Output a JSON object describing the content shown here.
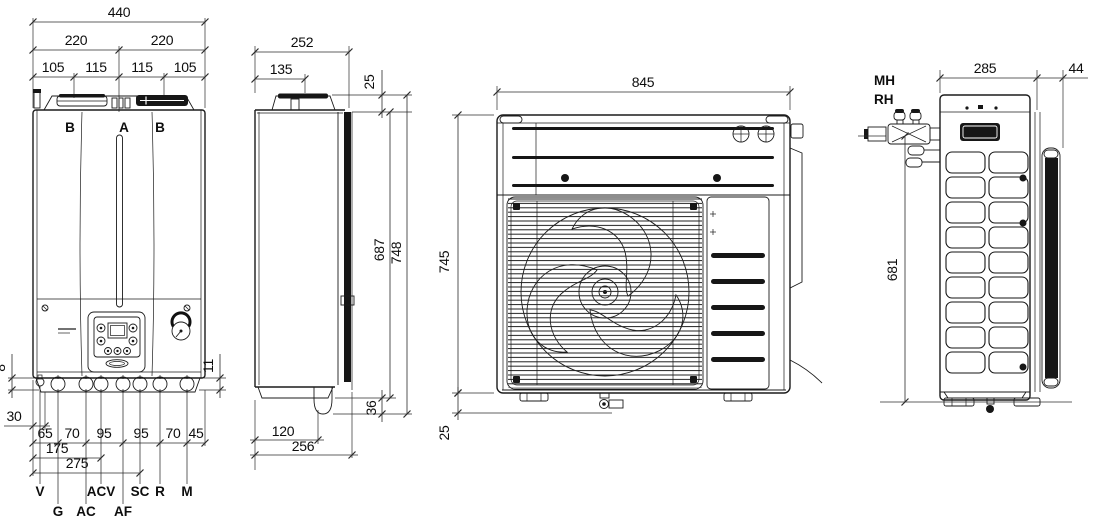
{
  "drawing": {
    "boiler_front": {
      "overall_width": "440",
      "half_width_left": "220",
      "half_width_right": "220",
      "seg_105_left": "105",
      "seg_115_left": "115",
      "seg_115_right": "115",
      "seg_105_right": "105",
      "flue_left": "B",
      "flue_center": "A",
      "flue_right": "B",
      "offset_8": "8",
      "offset_30": "30",
      "offset_11": "11",
      "pitch_65": "65",
      "pitch_70_left": "70",
      "pitch_95_left": "95",
      "pitch_95_right": "95",
      "pitch_70_right": "70",
      "pitch_45": "45",
      "cum_175": "175",
      "cum_275": "275",
      "conn_v": "V",
      "conn_g": "G",
      "conn_ac": "AC",
      "conn_acv": "ACV",
      "conn_af": "AF",
      "conn_sc": "SC",
      "conn_r": "R",
      "conn_m": "M"
    },
    "boiler_side": {
      "depth": "252",
      "flue_offset": "135",
      "top_clearance": "25",
      "body_height": "687",
      "total_height": "748",
      "bottom_clearance": "36",
      "base_offset": "120",
      "base_depth": "256"
    },
    "outdoor_front": {
      "width": "845",
      "height": "745",
      "drain_offset": "25"
    },
    "outdoor_side": {
      "valve_mh": "MH",
      "valve_rh": "RH",
      "depth": "285",
      "coil_depth": "44",
      "valve_height": "681"
    }
  }
}
